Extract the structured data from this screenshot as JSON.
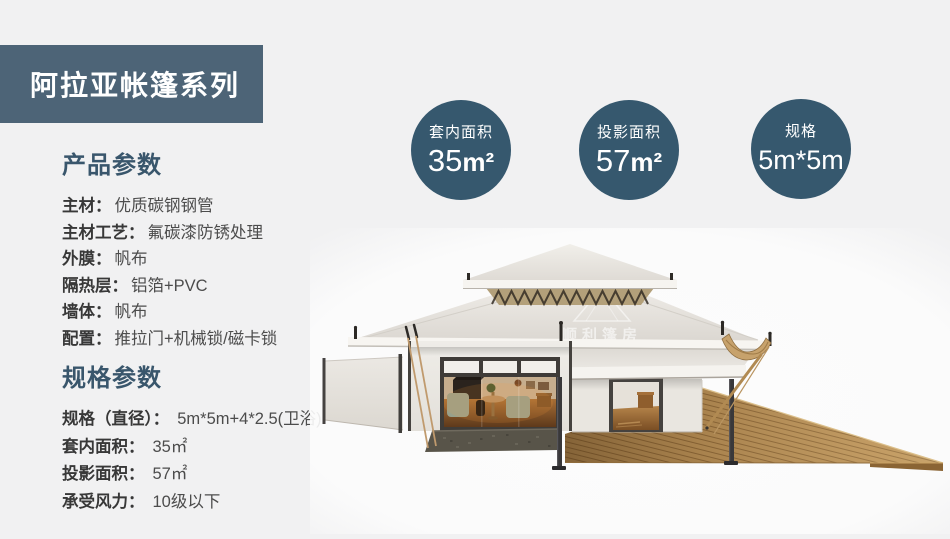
{
  "page": {
    "background": "#f1f1f2"
  },
  "banner": {
    "title": "阿拉亚帐篷系列",
    "bg": "#4d6477"
  },
  "product_params": {
    "heading": "产品参数",
    "rows": [
      {
        "label": "主材：",
        "value": "优质碳钢钢管"
      },
      {
        "label": "主材工艺：",
        "value": "氟碳漆防锈处理"
      },
      {
        "label": "外膜：",
        "value": "帆布"
      },
      {
        "label": "隔热层：",
        "value": "铝箔+PVC"
      },
      {
        "label": "墙体：",
        "value": "帆布"
      },
      {
        "label": "配置：",
        "value": "推拉门+机械锁/磁卡锁"
      }
    ]
  },
  "spec_params": {
    "heading": "规格参数",
    "rows": [
      {
        "label": "规格（直径）：",
        "value": "5m*5m+4*2.5(卫浴)"
      },
      {
        "label": "套内面积：",
        "value": "35㎡"
      },
      {
        "label": "投影面积：",
        "value": "57㎡"
      },
      {
        "label": "承受风力：",
        "value": "10级以下"
      }
    ]
  },
  "badges": [
    {
      "label": "套内面积",
      "value": "35",
      "unit": "m²"
    },
    {
      "label": "投影面积",
      "value": "57",
      "unit": "m²"
    },
    {
      "label": "规格",
      "value": "5m*5m",
      "unit": ""
    }
  ],
  "tent_render": {
    "watermark_cn": "顺利篷房",
    "watermark_en": "WELL TENT"
  },
  "colors": {
    "banner_bg": "#4d6477",
    "badge_bg": "#36586e",
    "heading_text": "#39566c"
  }
}
